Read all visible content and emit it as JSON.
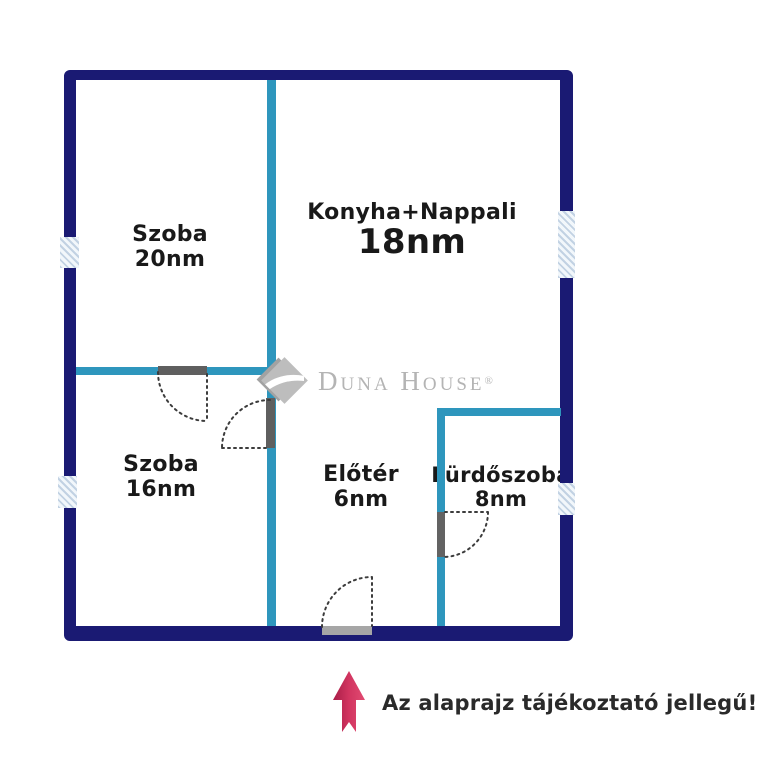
{
  "rooms": [
    {
      "name": "Szoba",
      "area": "20nm"
    },
    {
      "name": "Konyha+Nappali",
      "area": "18nm"
    },
    {
      "name": "Szoba",
      "area": "16nm"
    },
    {
      "name": "Előtér",
      "area": "6nm"
    },
    {
      "name": "Fürdőszoba",
      "area": "8nm"
    }
  ],
  "watermark": {
    "brand": "Duna House",
    "registered": "®"
  },
  "footer": {
    "disclaimer": "Az alaprajz tájékoztató jellegű!"
  },
  "icons": {
    "logo_mark": "duna-house-diamond-icon",
    "direction_arrow": "up-arrow-icon"
  },
  "colors": {
    "outer_wall": "#1a1a73",
    "inner_wall": "#2e96bd",
    "window_fill": "#dde7f1",
    "door_line": "#3c3c3c",
    "logo_grey": "#b4b4b4",
    "arrow_red_dark": "#a81d47",
    "arrow_red_light": "#e14b72",
    "label_text": "#191919"
  }
}
